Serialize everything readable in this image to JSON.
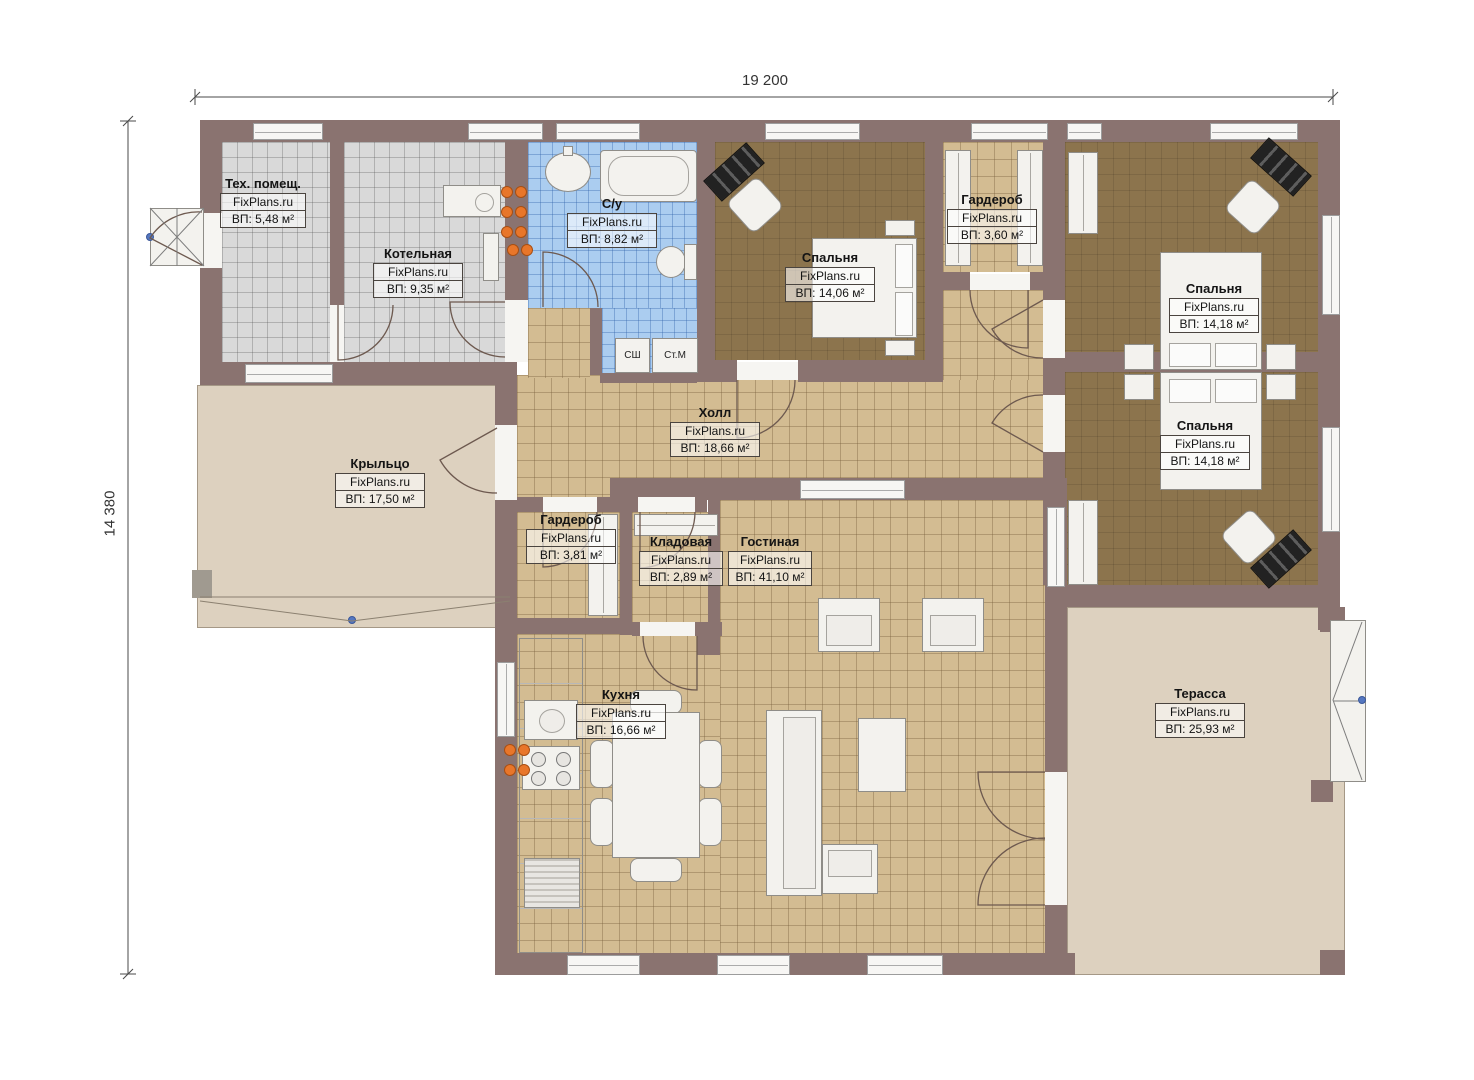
{
  "plan": {
    "dimensions": {
      "width_label": "19 200",
      "height_label": "14 380"
    },
    "watermark": "FixPlans.ru",
    "rooms": [
      {
        "key": "tech",
        "name": "Тех. помещ.",
        "area": "ВП: 5,48 м²"
      },
      {
        "key": "boiler",
        "name": "Котельная",
        "area": "ВП: 9,35 м²"
      },
      {
        "key": "bathroom",
        "name": "С/у",
        "area": "ВП: 8,82 м²"
      },
      {
        "key": "bedroom-1",
        "name": "Спальня",
        "area": "ВП: 14,06 м²"
      },
      {
        "key": "wardrobe-1",
        "name": "Гардероб",
        "area": "ВП: 3,60 м²"
      },
      {
        "key": "bedroom-2",
        "name": "Спальня",
        "area": "ВП: 14,18 м²"
      },
      {
        "key": "bedroom-3",
        "name": "Спальня",
        "area": "ВП: 14,18 м²"
      },
      {
        "key": "hall",
        "name": "Холл",
        "area": "ВП: 18,66 м²"
      },
      {
        "key": "porch",
        "name": "Крыльцо",
        "area": "ВП: 17,50 м²"
      },
      {
        "key": "wardrobe-2",
        "name": "Гардероб",
        "area": "ВП: 3,81 м²"
      },
      {
        "key": "storage",
        "name": "Кладовая",
        "area": "ВП: 2,89 м²"
      },
      {
        "key": "living",
        "name": "Гостиная",
        "area": "ВП: 41,10 м²"
      },
      {
        "key": "kitchen",
        "name": "Кухня",
        "area": "ВП: 16,66 м²"
      },
      {
        "key": "terrace",
        "name": "Терасса",
        "area": "ВП: 25,93 м²"
      }
    ],
    "appliances": {
      "dryer": "СШ",
      "washer": "Ст.М"
    },
    "colors": {
      "wall": "#8a7370",
      "floor_tile_tan": "#d3bc92",
      "floor_tile_gray": "#d9d9d9",
      "floor_tile_blue": "#abcdf0",
      "floor_bedroom_brown": "#8c744d",
      "outdoor_beige": "#ddd1bf",
      "furniture_white": "#f3f2ee",
      "radiator_orange": "#e8762a",
      "marker_blue": "#5577c0",
      "line_dark": "#6d594f"
    }
  }
}
